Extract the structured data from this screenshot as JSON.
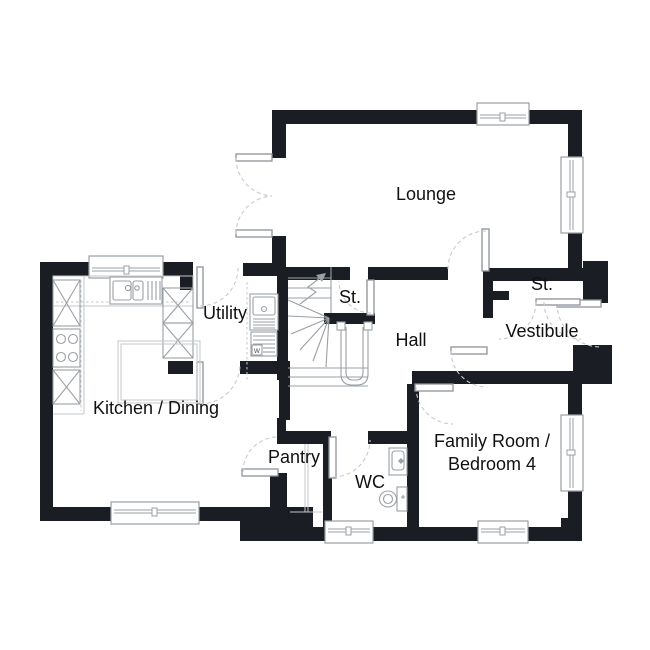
{
  "rooms": {
    "lounge": "Lounge",
    "stairs_store": "St.",
    "utility": "Utility",
    "hall": "Hall",
    "store": "St.",
    "vestibule": "Vestibule",
    "kitchen_dining": "Kitchen / Dining",
    "pantry": "Pantry",
    "wc": "WC",
    "family_room_line1": "Family Room /",
    "family_room_line2": "Bedroom 4"
  },
  "appliances": {
    "washer_label": "w"
  },
  "colors": {
    "wall": "#1a1e24",
    "fixture": "#9aa0a5",
    "fixture_light": "#c3c7cb",
    "door_leaf": "#8d9298",
    "door_arc": "#c6cace",
    "label": "#111111",
    "background": "#ffffff"
  }
}
